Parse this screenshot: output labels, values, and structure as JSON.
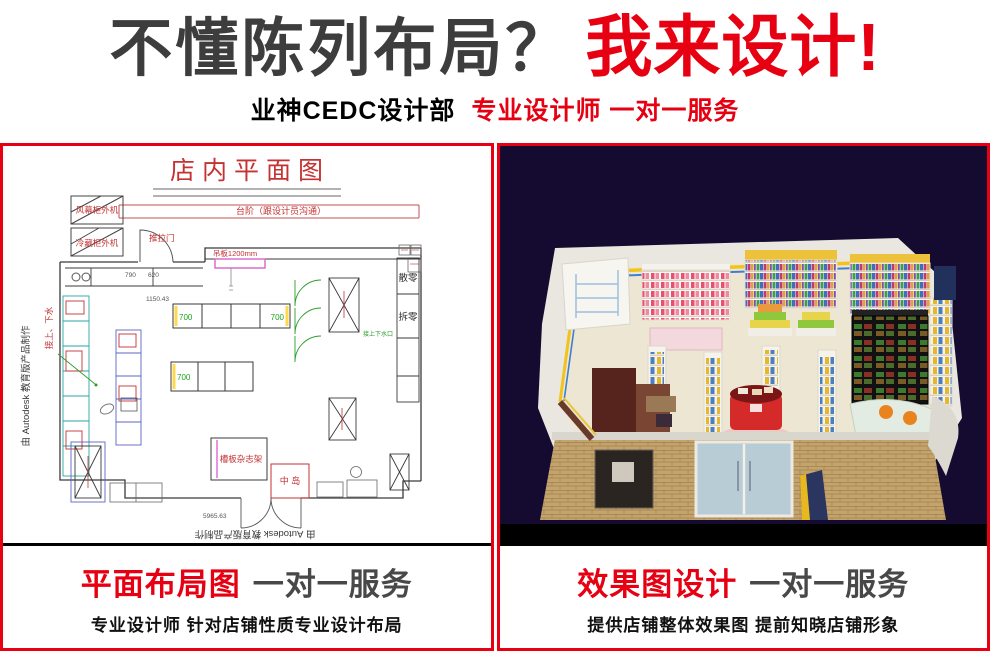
{
  "header": {
    "headline_dark": "不懂陈列布局？",
    "headline_red": "我来设计!",
    "subtitle_dark": "业神CEDC设计部",
    "subtitle_red": "专业设计师 一对一服务"
  },
  "colors": {
    "accent_red": "#e60012",
    "headline_gray": "#3d3d3d",
    "panel_border": "#e60012",
    "render_background": "#150a30",
    "cad_red": "#c43232"
  },
  "left_panel": {
    "caption": {
      "title_red": "平面布局图",
      "title_dark": "一对一服务",
      "subtitle": "专业设计师 针对店铺性质专业设计布局"
    },
    "floorplan": {
      "title": "店内平面图",
      "watermark": "由 Autodesk 教育版产品制作",
      "labels": {
        "machine_top": "风幕柜外机",
        "machine_bottom": "冷藏柜外机",
        "step_note": "台阶（跟设计员沟通）",
        "door": "推拉门",
        "hanging_board": "吊板1200mm",
        "water_note": "接上、下水",
        "water_note_green": "接上下水口",
        "magazine_rack": "槽板杂志架",
        "center_island": "中 岛",
        "loose_sale_a": "散零",
        "loose_sale_b": "拆零"
      },
      "dimensions": {
        "g1_left": "700",
        "g1_right": "700",
        "g2_left": "700",
        "col_a": "790",
        "col_b": "620",
        "gondola_length": "1150.43",
        "total_width": "5965.63"
      }
    }
  },
  "right_panel": {
    "caption": {
      "title_red": "效果图设计",
      "title_dark": "一对一服务",
      "subtitle": "提供店铺整体效果图 提前知晓店铺形象"
    }
  }
}
